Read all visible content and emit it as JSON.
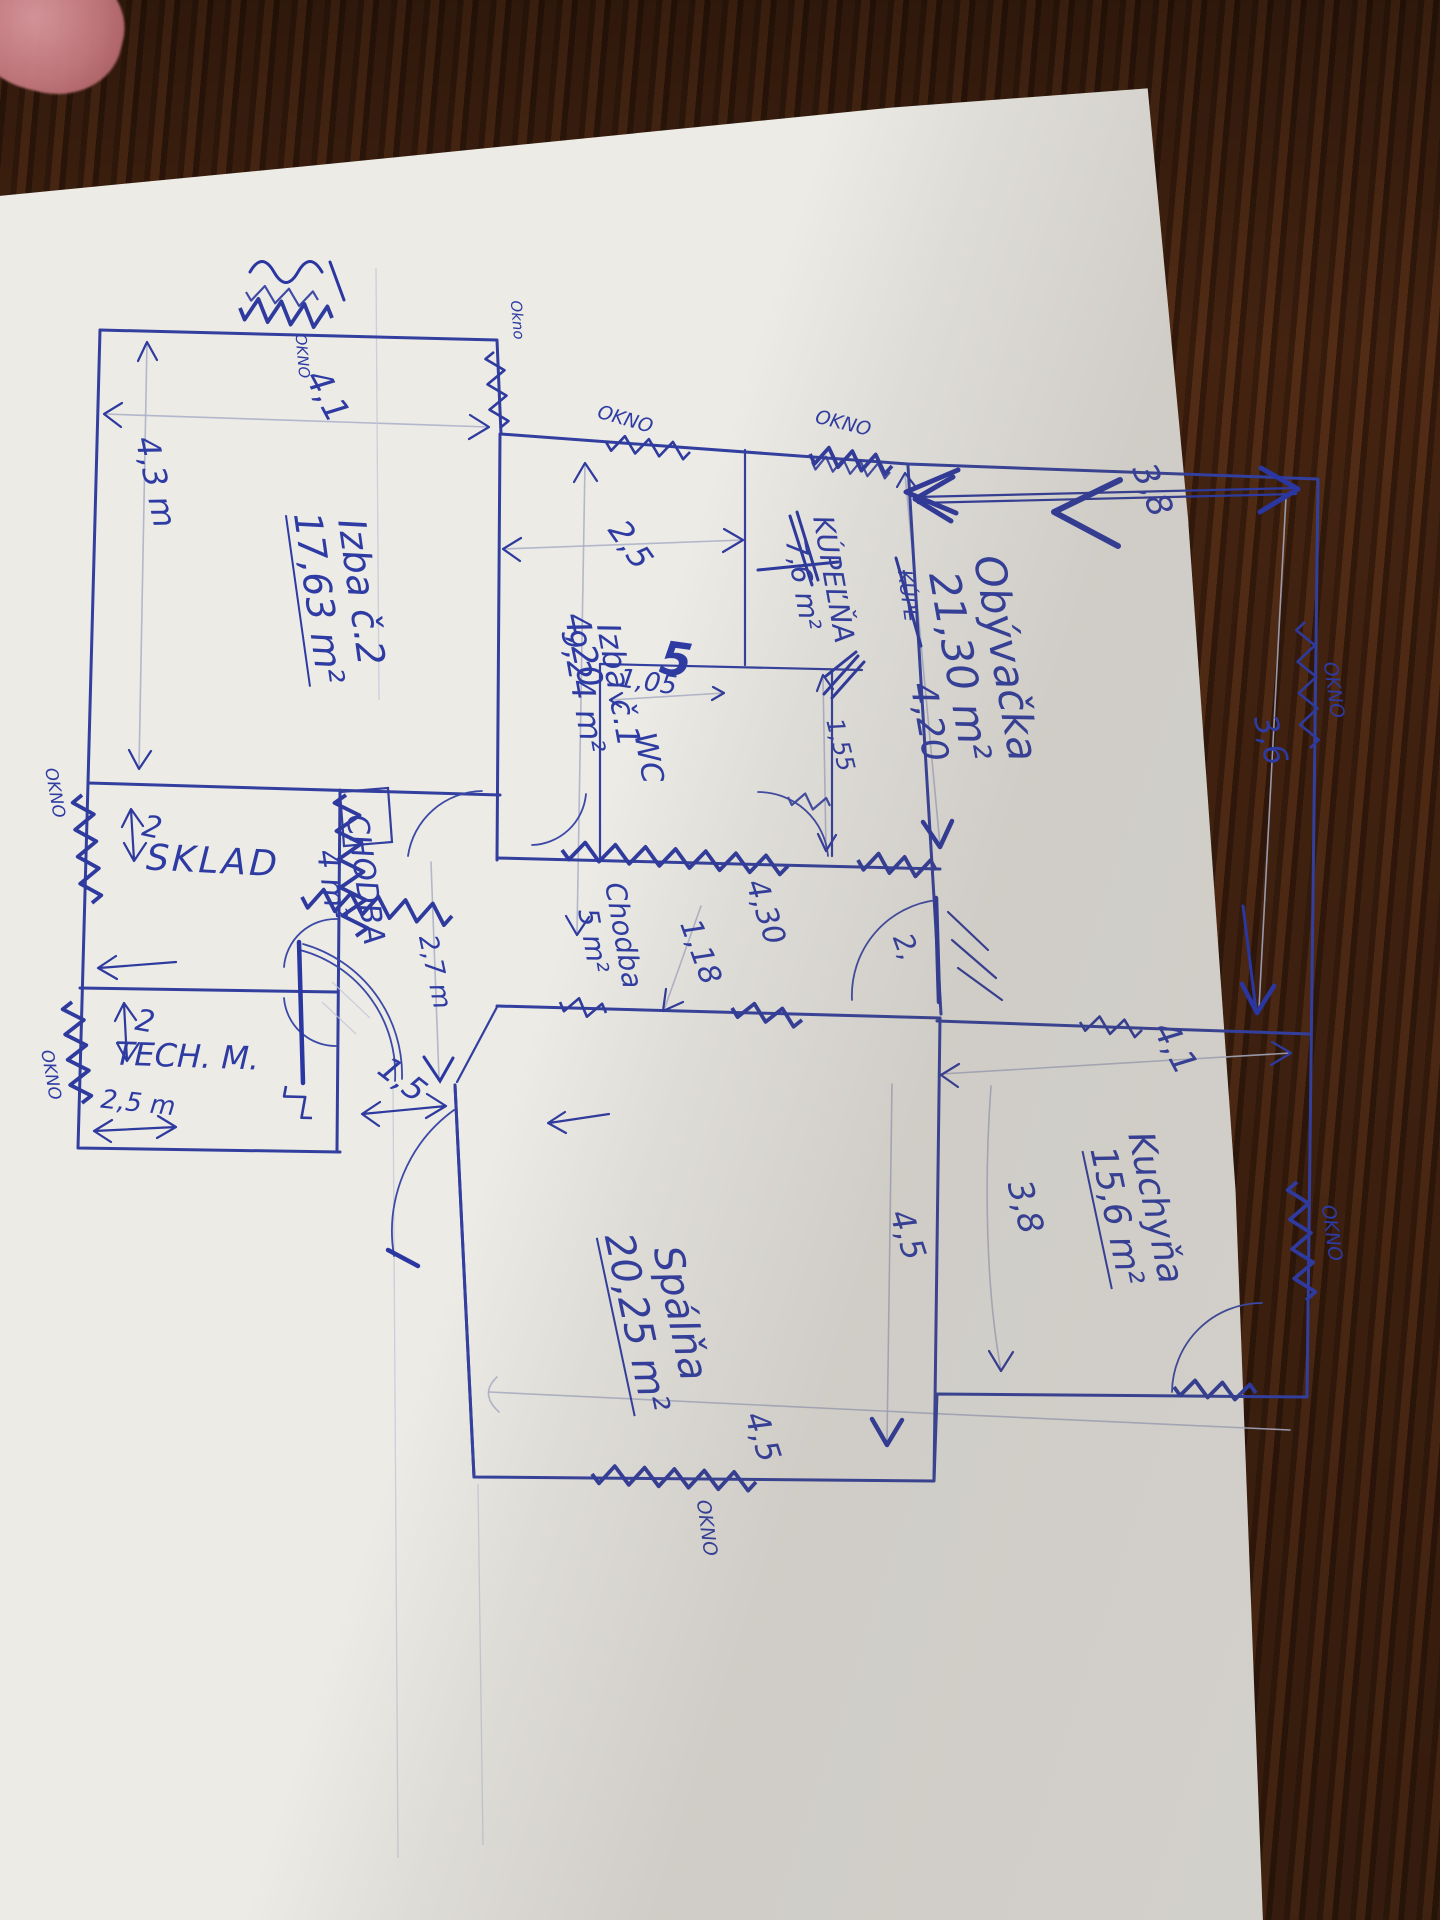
{
  "photo": {
    "window_label": "OKNO",
    "window_label_alt": "Okno"
  },
  "rooms": {
    "izba2": {
      "name": "Izba č.2",
      "area": "17,63 m²"
    },
    "izba1": {
      "name": "Izba č.1",
      "area": "9,24 m²"
    },
    "kupelna": {
      "name": "KÚPEĽŇA",
      "area": "7,6 m²"
    },
    "wc": {
      "name": "WC"
    },
    "obyvacka": {
      "name": "Obývačka",
      "area": "21,30 m²"
    },
    "kuchyna": {
      "name": "Kuchyňa",
      "area": "15,6 m²"
    },
    "spalna": {
      "name": "Spálňa",
      "area": "20,25 m²"
    },
    "sklad": {
      "name": "SKLAD"
    },
    "tech_m": {
      "name": "TECH. M."
    },
    "chodba4": {
      "name": "CHODBA",
      "area": "4 m²"
    },
    "chodba5": {
      "name": "Chodba",
      "area": "5 m²"
    }
  },
  "dims": {
    "izba2_width": "4,1",
    "izba2_height": "4,3 m",
    "izba1_width": "2,5",
    "izba1_height": "4,20",
    "kupl_label": "KÚPL",
    "kupl_length": "4,20",
    "wc_width": "1,05",
    "wc_width_big": "5",
    "wc_height": "1,55",
    "obyvacka_top": "3,8",
    "obyvacka_right": "3,6",
    "kuchyna_width": "4,1",
    "kuchyna_height": "3,8",
    "chodba5_width": "4,30",
    "chodba5_height": "1,18",
    "spalna_height": "4,5",
    "spalna_width": "4,5",
    "chodba4_height": "2,7 m",
    "chodba4_width": "1,5",
    "sklad_width": "2",
    "techm_height": "2",
    "techm_width": "2,5 m",
    "door_width": "2,"
  }
}
